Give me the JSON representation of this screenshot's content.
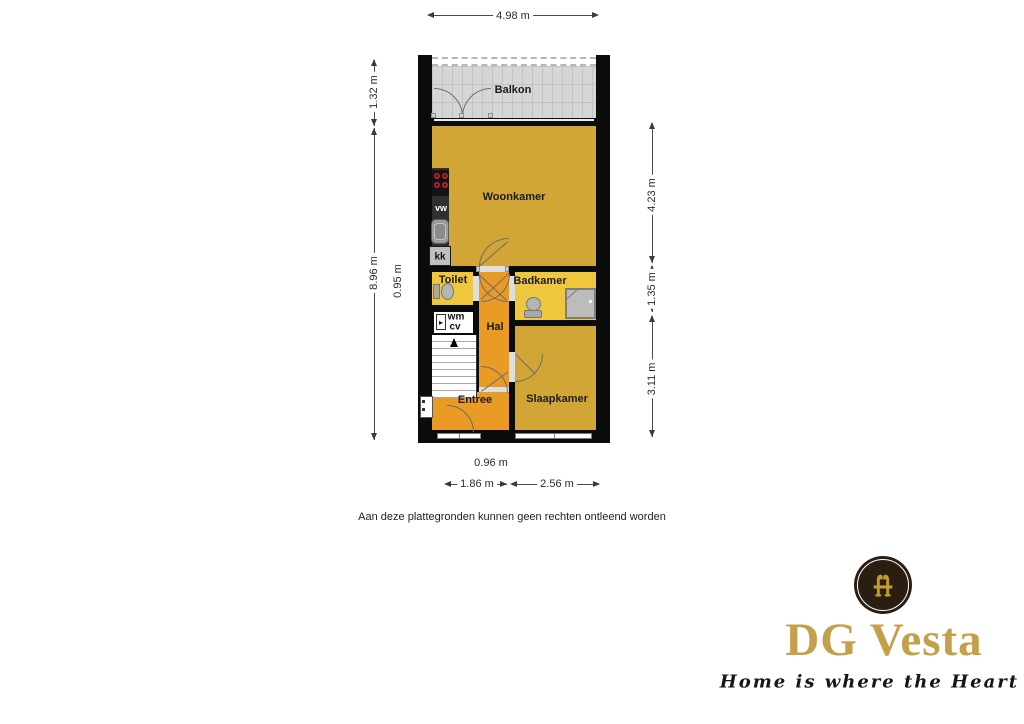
{
  "plan": {
    "rooms": {
      "balkon": "Balkon",
      "woonkamer": "Woonkamer",
      "toilet": "Toilet",
      "badkamer": "Badkamer",
      "hal": "Hal",
      "entree": "Entree",
      "slaapkamer": "Slaapkamer"
    },
    "appliances": {
      "vw": "vw",
      "kk": "kk",
      "wm": "wm",
      "cv": "cv"
    },
    "icons": {
      "boiler": "▸"
    },
    "dimensions": {
      "top_width": "4.98 m",
      "left_balcony_height": "1.32 m",
      "left_total_height": "8.96 m",
      "left_inner": "0.95 m",
      "right_upper": "4.23 m",
      "right_middle": "1.35 m",
      "right_lower": "3.11 m",
      "bottom_inner": "0.96 m",
      "bottom_left": "1.86 m",
      "bottom_right": "2.56 m"
    }
  },
  "disclaimer": "Aan deze plattegronden kunnen geen rechten ontleend worden",
  "logo": {
    "name": "DG Vesta",
    "tagline": "Home is where the Heart is"
  },
  "colors": {
    "room_gold": "#d1a636",
    "room_yellow": "#eec73e",
    "room_orange": "#e99b26",
    "balcony_gray": "#d6d6d6",
    "wall_black": "#0b0b0b",
    "counter_dark": "#2f2f2f",
    "burner_red": "#b3232e",
    "logo_gold": "#c3a14b",
    "logo_circle_bg": "#2a1e12"
  }
}
